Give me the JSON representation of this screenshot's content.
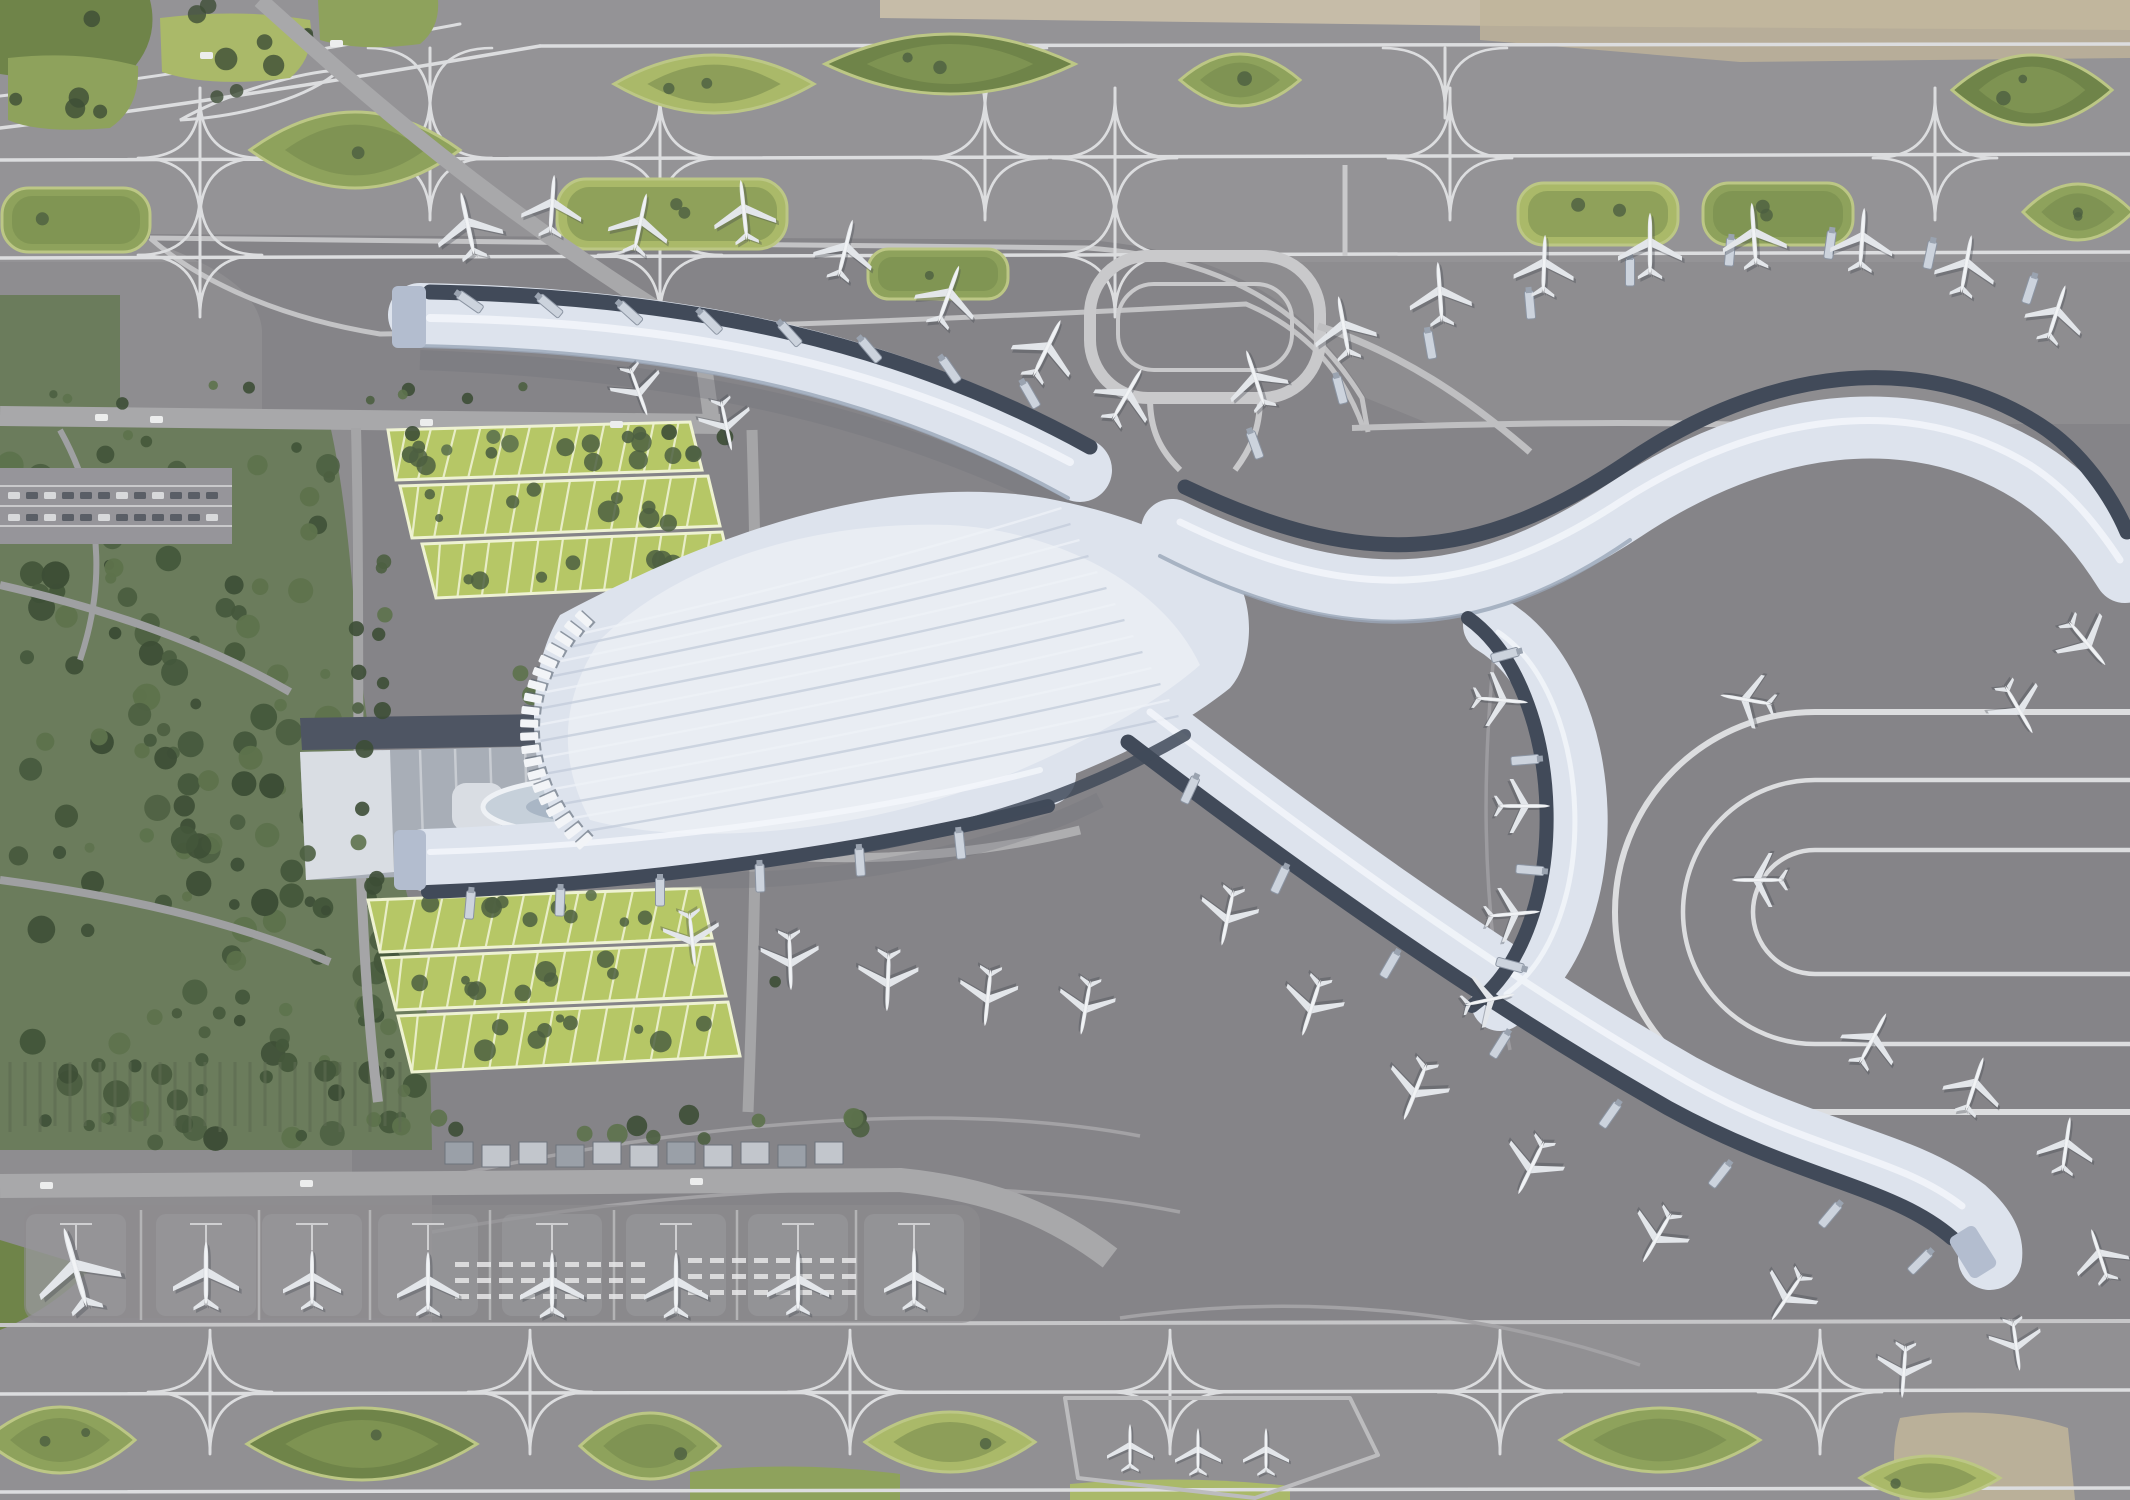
{
  "scene": {
    "title": "Aerial rendering of an airport master plan with X-shaped terminal",
    "width": 2130,
    "height": 1500
  },
  "palette": {
    "base": "#8e8d90",
    "strip": "#929194",
    "apron": "#858488",
    "apron_light": "#97969a",
    "pad": "#9b9a9e",
    "line_white": "#dcdddf",
    "line_light": "#bfbfc1",
    "road": "#a8a8aa",
    "road_light": "#b6b6b8",
    "terminal": "#dde3ed",
    "terminal_hi": "#f2f5f9",
    "terminal_rib": "#c2cbd9",
    "terminal_edge": "#9aa6b8",
    "dark_strip": "#414a59",
    "bridge": "#ccd3dd",
    "tip_cap": "#b3bdcf",
    "plane": "#e3e6ea",
    "plane_shadow": "#3c414a",
    "green_mid": "#8ea25c",
    "green_dark": "#6f8449",
    "green_light": "#aab969",
    "island_edge": "#bcc785",
    "tree_dark": "#3d4e36",
    "tree_mid": "#4c5f41",
    "tree_light": "#5d724c",
    "forest_base": "#6b7c5c",
    "garage_green": "#b6c766",
    "garage_line": "#eef2d2",
    "gtc_gray": "#a8aeb7",
    "gtc_dark": "#4e5563",
    "canopy_white": "#d9dde3",
    "oval_fill": "#c6d0da",
    "oval_inner": "#a9b6c5",
    "tan": "#bfb49a",
    "tan_light": "#cfc3ab"
  },
  "islands_top": [
    [
      355,
      150,
      210,
      76,
      "lens",
      "mid"
    ],
    [
      672,
      214,
      230,
      70,
      "rrect",
      "light"
    ],
    [
      950,
      64,
      250,
      60,
      "lens",
      "dark"
    ],
    [
      938,
      274,
      140,
      50,
      "rrect",
      "mid"
    ],
    [
      1240,
      80,
      120,
      52,
      "lens",
      "mid"
    ],
    [
      1598,
      214,
      160,
      62,
      "rrect",
      "light"
    ],
    [
      1778,
      214,
      150,
      62,
      "rrect",
      "mid"
    ],
    [
      2032,
      90,
      160,
      70,
      "lens",
      "dark"
    ],
    [
      2078,
      212,
      110,
      56,
      "lens",
      "mid"
    ],
    [
      76,
      220,
      148,
      64,
      "rrect",
      "mid"
    ],
    [
      714,
      84,
      200,
      58,
      "lens",
      "light"
    ]
  ],
  "islands_bottom": [
    [
      60,
      1440,
      150,
      66,
      "lens",
      "mid"
    ],
    [
      362,
      1444,
      230,
      72,
      "lens",
      "dark"
    ],
    [
      650,
      1446,
      140,
      66,
      "lens",
      "mid"
    ],
    [
      950,
      1442,
      170,
      60,
      "lens",
      "light"
    ],
    [
      1660,
      1440,
      200,
      64,
      "lens",
      "mid"
    ],
    [
      1930,
      1478,
      140,
      44,
      "lens",
      "light"
    ]
  ],
  "crossings_top": [
    [
      200,
      158,
      70,
      60
    ],
    [
      430,
      158,
      70,
      60
    ],
    [
      660,
      158,
      70,
      60
    ],
    [
      985,
      158,
      70,
      60
    ],
    [
      1115,
      158,
      70,
      60
    ],
    [
      1450,
      158,
      70,
      60
    ],
    [
      1935,
      158,
      70,
      60
    ],
    [
      200,
      255,
      60,
      50
    ],
    [
      660,
      255,
      60,
      50
    ],
    [
      1115,
      255,
      60,
      50
    ],
    [
      430,
      48,
      0,
      70
    ],
    [
      985,
      48,
      0,
      70
    ],
    [
      1445,
      48,
      0,
      70
    ]
  ],
  "crossings_bottom": [
    [
      210,
      1392,
      45,
      60
    ],
    [
      530,
      1392,
      45,
      60
    ],
    [
      850,
      1392,
      45,
      60
    ],
    [
      1170,
      1392,
      45,
      60
    ],
    [
      1500,
      1392,
      45,
      60
    ],
    [
      1820,
      1392,
      45,
      60
    ]
  ],
  "aircraft": [
    [
      468,
      226,
      -12,
      66
    ],
    [
      552,
      206,
      4,
      60
    ],
    [
      640,
      224,
      12,
      60
    ],
    [
      744,
      212,
      -6,
      62
    ],
    [
      845,
      250,
      14,
      60
    ],
    [
      948,
      296,
      20,
      62
    ],
    [
      1046,
      350,
      26,
      64
    ],
    [
      1126,
      396,
      30,
      60
    ],
    [
      638,
      390,
      160,
      52
    ],
    [
      726,
      424,
      168,
      52
    ],
    [
      1256,
      380,
      -18,
      60
    ],
    [
      1344,
      328,
      -10,
      62
    ],
    [
      1440,
      294,
      -4,
      62
    ],
    [
      1544,
      266,
      2,
      60
    ],
    [
      1650,
      246,
      0,
      64
    ],
    [
      1754,
      236,
      -4,
      64
    ],
    [
      1862,
      240,
      4,
      62
    ],
    [
      1966,
      266,
      10,
      60
    ],
    [
      2056,
      314,
      18,
      58
    ],
    [
      2086,
      642,
      140,
      58
    ],
    [
      2018,
      708,
      150,
      56
    ],
    [
      1500,
      700,
      95,
      54
    ],
    [
      1522,
      806,
      90,
      54
    ],
    [
      1512,
      914,
      85,
      54
    ],
    [
      1488,
      1000,
      78,
      52
    ],
    [
      1748,
      700,
      -80,
      54
    ],
    [
      1760,
      880,
      -90,
      54
    ],
    [
      1228,
      916,
      192,
      58
    ],
    [
      1312,
      1006,
      198,
      60
    ],
    [
      1416,
      1090,
      202,
      62
    ],
    [
      1532,
      1166,
      206,
      60
    ],
    [
      1658,
      1236,
      210,
      58
    ],
    [
      1788,
      1296,
      214,
      56
    ],
    [
      1872,
      1040,
      28,
      58
    ],
    [
      1974,
      1086,
      18,
      58
    ],
    [
      2066,
      1146,
      8,
      56
    ],
    [
      2100,
      1256,
      -18,
      54
    ],
    [
      1904,
      1370,
      184,
      54
    ],
    [
      2016,
      1344,
      172,
      52
    ],
    [
      692,
      938,
      174,
      56
    ],
    [
      790,
      960,
      178,
      58
    ],
    [
      888,
      980,
      182,
      60
    ],
    [
      988,
      996,
      186,
      58
    ],
    [
      1086,
      1006,
      190,
      56
    ],
    [
      76,
      1270,
      -16,
      84
    ],
    [
      206,
      1276,
      0,
      66
    ],
    [
      312,
      1280,
      0,
      58
    ],
    [
      428,
      1284,
      0,
      62
    ],
    [
      552,
      1285,
      0,
      64
    ],
    [
      676,
      1285,
      0,
      64
    ],
    [
      798,
      1283,
      0,
      62
    ],
    [
      914,
      1279,
      0,
      60
    ],
    [
      1130,
      1448,
      0,
      46
    ],
    [
      1198,
      1452,
      0,
      46
    ],
    [
      1266,
      1452,
      0,
      46
    ]
  ],
  "aircraft_count": 55,
  "jet_bridges": [
    [
      470,
      302,
      -55
    ],
    [
      550,
      306,
      -50
    ],
    [
      630,
      313,
      -48
    ],
    [
      710,
      322,
      -45
    ],
    [
      790,
      334,
      -42
    ],
    [
      870,
      350,
      -40
    ],
    [
      950,
      370,
      -35
    ],
    [
      1030,
      395,
      -30
    ],
    [
      1255,
      445,
      -20
    ],
    [
      1340,
      390,
      -15
    ],
    [
      1430,
      345,
      -10
    ],
    [
      1530,
      305,
      -5
    ],
    [
      1630,
      272,
      0
    ],
    [
      1730,
      252,
      5
    ],
    [
      1830,
      245,
      8
    ],
    [
      1930,
      255,
      12
    ],
    [
      2030,
      290,
      18
    ],
    [
      1505,
      655,
      75
    ],
    [
      1525,
      760,
      85
    ],
    [
      1530,
      870,
      95
    ],
    [
      1510,
      965,
      105
    ],
    [
      1190,
      790,
      25
    ],
    [
      1280,
      880,
      25
    ],
    [
      1390,
      965,
      30
    ],
    [
      1500,
      1045,
      32
    ],
    [
      1610,
      1115,
      35
    ],
    [
      1720,
      1175,
      38
    ],
    [
      1830,
      1215,
      40
    ],
    [
      1920,
      1262,
      45
    ],
    [
      470,
      905,
      5
    ],
    [
      560,
      902,
      2
    ],
    [
      660,
      892,
      0
    ],
    [
      760,
      878,
      -2
    ],
    [
      860,
      862,
      -4
    ],
    [
      960,
      845,
      -6
    ]
  ],
  "facade_ticks": {
    "cx": 742,
    "cy": 730,
    "rx": 212,
    "ry": 165,
    "from": 138,
    "to": 222,
    "count": 20
  },
  "garage_north_rows": [
    [
      388,
      430,
      690,
      422,
      702,
      470,
      396,
      480
    ],
    [
      400,
      486,
      708,
      476,
      720,
      526,
      412,
      538
    ],
    [
      422,
      544,
      722,
      532,
      734,
      584,
      436,
      598
    ]
  ],
  "garage_south_rows": [
    [
      368,
      900,
      700,
      888,
      712,
      938,
      380,
      952
    ],
    [
      382,
      958,
      714,
      944,
      726,
      996,
      396,
      1010
    ],
    [
      398,
      1016,
      728,
      1002,
      740,
      1056,
      412,
      1072
    ]
  ],
  "stand_row": {
    "xs": [
      76,
      206,
      312,
      428,
      552,
      676,
      798,
      914
    ],
    "y_top": 1210,
    "y_bot": 1320
  },
  "service_buildings": {
    "x0": 445,
    "y": 1142,
    "count": 11,
    "w": 28,
    "h": 22,
    "step": 37
  },
  "zebra_groups": [
    {
      "x0": 455,
      "y0": 1262,
      "rows": 3,
      "cols": 9,
      "dx": 22,
      "dy": 16
    },
    {
      "x0": 688,
      "y0": 1258,
      "rows": 3,
      "cols": 8,
      "dx": 22,
      "dy": 16
    }
  ],
  "cars": [
    [
      95,
      414
    ],
    [
      150,
      416
    ],
    [
      420,
      419
    ],
    [
      610,
      421
    ],
    [
      40,
      1182
    ],
    [
      300,
      1180
    ],
    [
      690,
      1178
    ],
    [
      200,
      52
    ],
    [
      330,
      40
    ]
  ],
  "forest_regions": [
    {
      "x": 6,
      "y": 430,
      "w": 330,
      "h": 570,
      "n": 110
    },
    {
      "x": 10,
      "y": 1005,
      "w": 410,
      "h": 140,
      "n": 45
    },
    {
      "x": 350,
      "y": 780,
      "w": 70,
      "h": 330,
      "n": 22
    }
  ],
  "tree_clusters": [
    {
      "x0": 380,
      "x1": 730,
      "y0": 432,
      "y1": 455,
      "n": 12,
      "r0": 5,
      "r1": 9
    },
    {
      "x0": 356,
      "x1": 392,
      "y0": 560,
      "y1": 900,
      "n": 10,
      "r0": 5,
      "r1": 9
    },
    {
      "x0": 300,
      "x1": 700,
      "y0": 660,
      "y1": 712,
      "n": 10,
      "r0": 5,
      "r1": 10
    },
    {
      "x0": 300,
      "x1": 740,
      "y0": 848,
      "y1": 896,
      "n": 10,
      "r0": 5,
      "r1": 10
    },
    {
      "x0": 742,
      "x1": 790,
      "y0": 600,
      "y1": 1000,
      "n": 8,
      "r0": 5,
      "r1": 9
    },
    {
      "x0": 430,
      "x1": 880,
      "y0": 1108,
      "y1": 1162,
      "n": 13,
      "r0": 6,
      "r1": 11
    },
    {
      "x0": 700,
      "x1": 780,
      "y0": 758,
      "y1": 842,
      "n": 6,
      "r0": 5,
      "r1": 8
    },
    {
      "x0": 30,
      "x1": 690,
      "y0": 384,
      "y1": 404,
      "n": 10,
      "r0": 4,
      "r1": 7
    }
  ],
  "nursery_rows": {
    "x0": 10,
    "x1": 400,
    "step": 15,
    "y0": 1058,
    "y1": 1132
  },
  "loop_pad": {
    "x": 1090,
    "y": 256,
    "w": 230,
    "h": 142,
    "r": 58
  },
  "u_loop": {
    "cx": 1815,
    "cy": 912,
    "radii": [
      200,
      132,
      62
    ],
    "x_end": 2130
  },
  "remote_pad_polygon": "1065,1398 1350,1398 1378,1455 1255,1498 1078,1478"
}
